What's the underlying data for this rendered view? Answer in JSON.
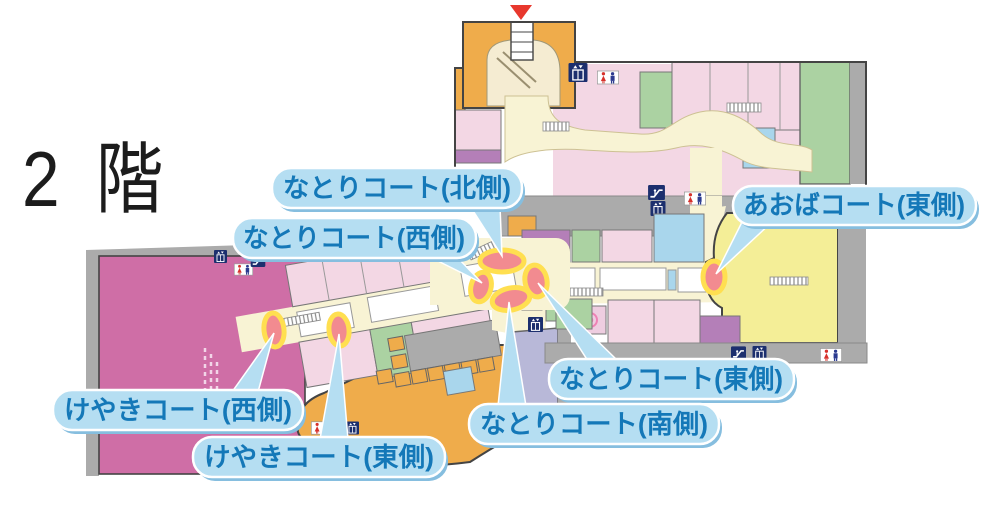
{
  "floor": {
    "title": "2 階"
  },
  "courts": [
    {
      "id": "natori-north",
      "label": "なとりコート(北側)"
    },
    {
      "id": "natori-west",
      "label": "なとりコート(西側)"
    },
    {
      "id": "aoba-east",
      "label": "あおばコート(東側)"
    },
    {
      "id": "natori-east",
      "label": "なとりコート(東側)"
    },
    {
      "id": "natori-south",
      "label": "なとりコート(南側)"
    },
    {
      "id": "keyaki-west",
      "label": "けやきコート(西側)"
    },
    {
      "id": "keyaki-east",
      "label": "けやきコート(東側)"
    }
  ],
  "icons": [
    "entrance-arrow-icon",
    "stairs-icon",
    "escalator-icon",
    "elevator-icon",
    "restroom-icon",
    "bench-icon",
    "spiral-icon"
  ],
  "colors": {
    "marker_fill": "#f28b90",
    "marker_halo": "#ffdf50",
    "label_bg": "#b5def2",
    "label_border": "#ffffff",
    "label_shadow": "#86bedf",
    "label_text": "#1478b8",
    "corridor": "#f8f3d4",
    "room_pink": "#f3d7e4",
    "anchor_magenta": "#cf6ea6",
    "anchor_yellow": "#f4ee97",
    "food_orange": "#efac4b",
    "room_green": "#abd2a2",
    "room_purple": "#b47fb8",
    "room_blue": "#a9d6ec",
    "south_lavender": "#b8b8d8",
    "wall_gray": "#ababab",
    "icon_navy": "#1c2f6e",
    "entrance_red": "#e8382d"
  }
}
